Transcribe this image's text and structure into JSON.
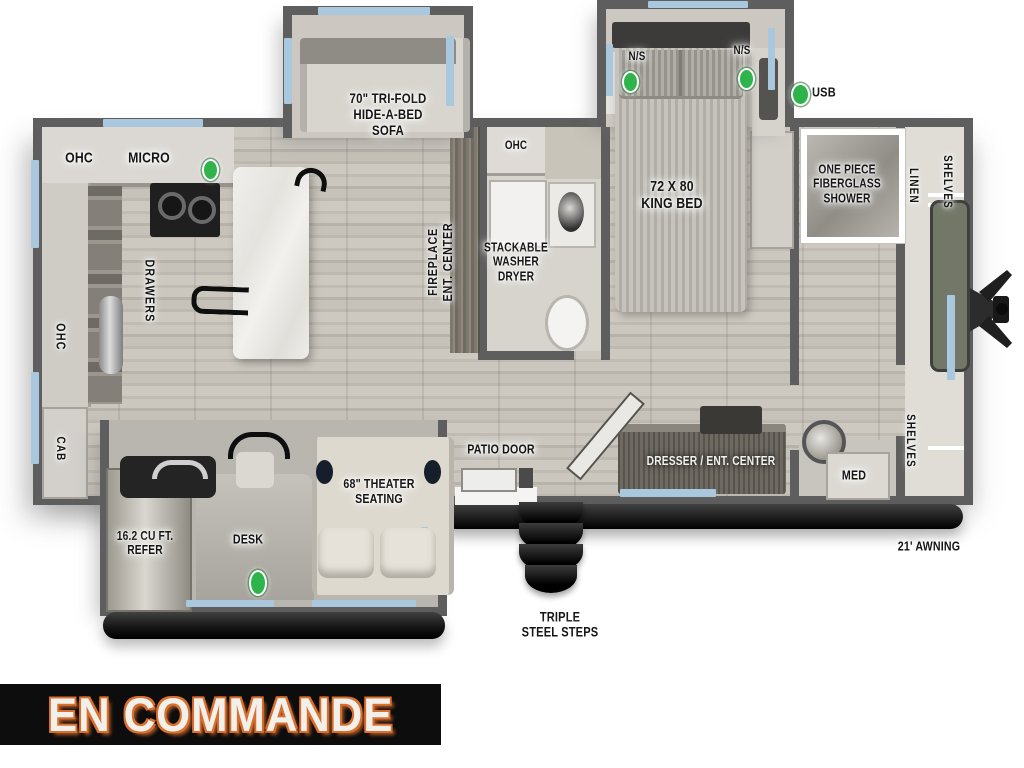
{
  "title": "Travel trailer floor plan - on order",
  "colors": {
    "wall": "#5e5e5e",
    "window": "#a9c7dd",
    "green": "#2fb34b",
    "awning": "#1d1d1d",
    "banner-bg": "#0d0d0d",
    "banner-text": "#f2f0eb",
    "banner-outline": "#d96f2f"
  },
  "status_banner": {
    "text": "EN COMMANDE"
  },
  "exterior": {
    "awning_label": "21' AWNING",
    "steps_label": "TRIPLE\nSTEEL STEPS",
    "usb_label": "USB"
  },
  "living_area": {
    "sofa_label": "70\" TRI-FOLD\nHIDE-A-BED\nSOFA",
    "fireplace_label": "FIREPLACE\nENT. CENTER",
    "theater_label": "68\" THEATER\nSEATING",
    "desk_label": "DESK",
    "patio_door_label": "PATIO DOOR"
  },
  "kitchen": {
    "ohc_top_label": "OHC",
    "micro_label": "MICRO",
    "ohc_side_label": "OHC",
    "drawers_label": "DRAWERS",
    "cab_label": "CAB",
    "refer_label": "16.2 CU FT.\nREFER"
  },
  "bathroom": {
    "ohc_label": "OHC",
    "washer_label": "STACKABLE\nWASHER\nDRYER"
  },
  "bedroom": {
    "bed_label": "72 X 80\nKING BED",
    "ns_left_label": "N/S",
    "ns_right_label": "N/S",
    "dresser_label": "DRESSER / ENT. CENTER"
  },
  "front_bath": {
    "shower_label": "ONE PIECE\nFIBERGLASS\nSHOWER",
    "med_label": "MED"
  },
  "front_closet": {
    "linen_label": "LINEN",
    "shelves_top_label": "SHELVES",
    "shelves_bottom_label": "SHELVES"
  }
}
